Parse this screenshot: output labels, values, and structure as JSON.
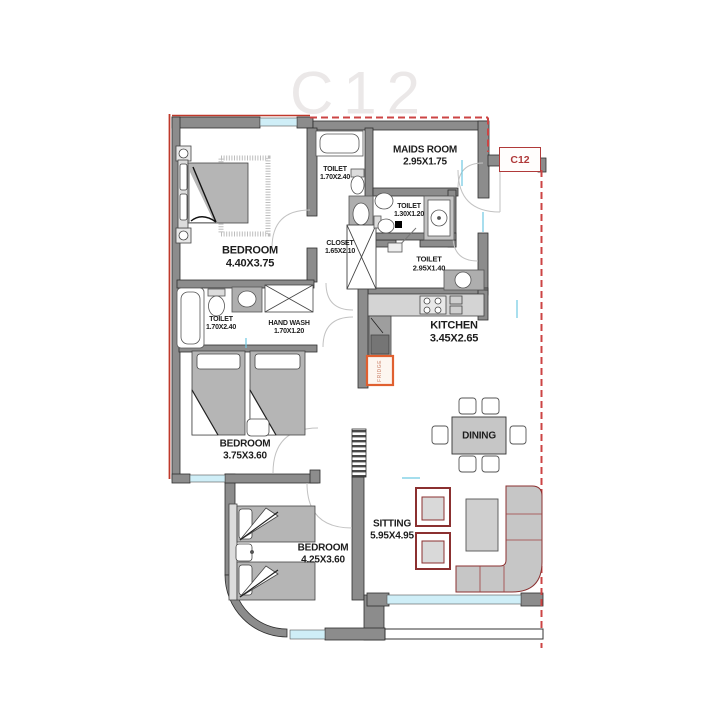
{
  "watermark": "C12",
  "unit_label": "C12",
  "rooms": {
    "master_bedroom": {
      "name": "BEDROOM",
      "dims": "4.40X3.75"
    },
    "bedroom2": {
      "name": "BEDROOM",
      "dims": "3.75X3.60"
    },
    "bedroom3": {
      "name": "BEDROOM",
      "dims": "4.25X3.60"
    },
    "maids_room": {
      "name": "MAIDS ROOM",
      "dims": "2.95X1.75"
    },
    "sitting": {
      "name": "SITTING",
      "dims": "5.95X4.95"
    },
    "kitchen": {
      "name": "KITCHEN",
      "dims": "3.45X2.65"
    },
    "dining": {
      "name": "DINING"
    },
    "toilet_master": {
      "name": "TOILET",
      "dims": "1.70X2.40"
    },
    "toilet_maids": {
      "name": "TOILET",
      "dims": "1.30X1.20"
    },
    "toilet_common": {
      "name": "TOILET",
      "dims": "2.95X1.40"
    },
    "toilet_guest": {
      "name": "TOILET",
      "dims": "1.70X2.40"
    },
    "hand_wash": {
      "name": "HAND WASH",
      "dims": "1.70X1.20"
    },
    "closet": {
      "name": "CLOSET",
      "dims": "1.65X2.10"
    }
  },
  "appliances": {
    "fridge": "FRIDGE"
  },
  "colors": {
    "wall": "#8c8c8c",
    "boundary_red": "#c0392b",
    "window_cyan": "#bfe8f2",
    "furniture_outline_red": "#8b3030",
    "counter_gray": "#d4d4d4"
  }
}
